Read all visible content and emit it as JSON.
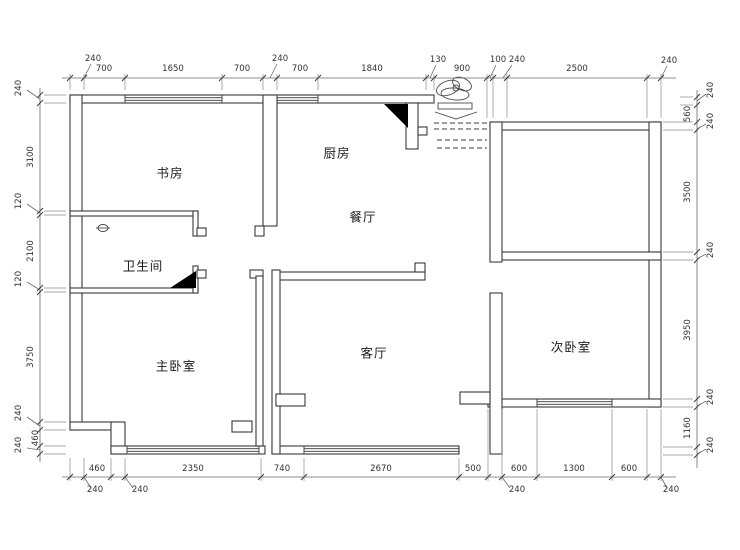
{
  "plan": {
    "rooms": [
      {
        "name": "书房"
      },
      {
        "name": "厨房"
      },
      {
        "name": "餐厅"
      },
      {
        "name": "卫生间"
      },
      {
        "name": "主卧室"
      },
      {
        "name": "客厅"
      },
      {
        "name": "次卧室"
      }
    ],
    "dimensions": {
      "top": [
        "240",
        "700",
        "1650",
        "700",
        "240",
        "700",
        "1840",
        "130",
        "900",
        "100",
        "240",
        "2500",
        "240"
      ],
      "bottom": [
        "240",
        "460",
        "240",
        "2350",
        "740",
        "2670",
        "500",
        "240",
        "600",
        "1300",
        "600",
        "240"
      ],
      "left": [
        "240",
        "3100",
        "120",
        "2100",
        "120",
        "3750",
        "240",
        "460",
        "240"
      ],
      "right": [
        "240",
        "560",
        "240",
        "3500",
        "240",
        "3950",
        "240",
        "1160",
        "240"
      ]
    },
    "icons": {
      "entry_decor": "plant-sketch-icon",
      "door_marker": "filled-triangle-icon",
      "drain": "phi-drain-icon"
    },
    "colors": {
      "line": "#383838",
      "dim": "#6a6a6a",
      "text": "#222222",
      "bg": "#ffffff"
    }
  }
}
